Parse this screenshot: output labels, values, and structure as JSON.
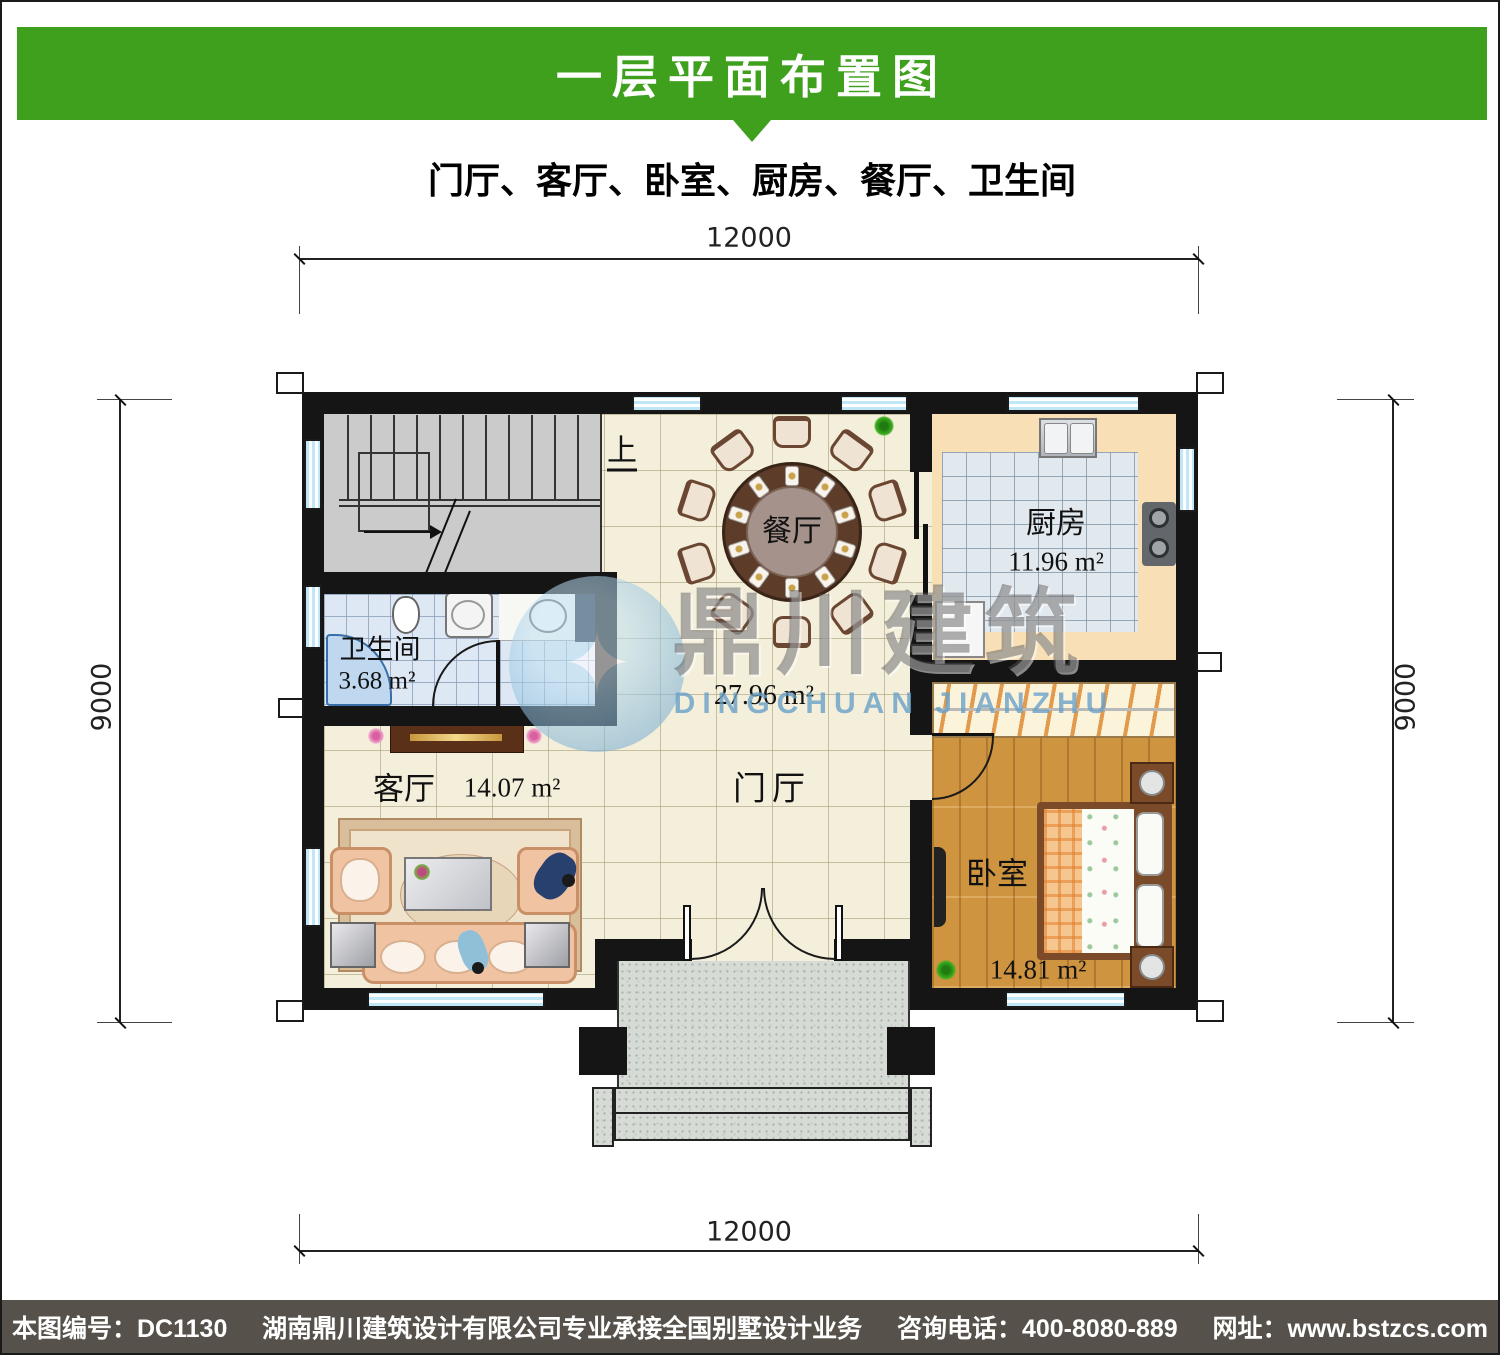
{
  "header": {
    "title": "一层平面布置图"
  },
  "subtitle": "门厅、客厅、卧室、厨房、餐厅、卫生间",
  "dimensions": {
    "top": "12000",
    "bottom": "12000",
    "left": "9000",
    "right": "9000"
  },
  "rooms": {
    "dining": {
      "name": "餐厅"
    },
    "kitchen": {
      "name": "厨房",
      "area": "11.96 m²"
    },
    "bathroom": {
      "name": "卫生间",
      "area": "3.68 m²"
    },
    "living": {
      "name": "客厅",
      "area": "14.07 m²"
    },
    "hall": {
      "name": "门厅",
      "area": "27.96 m²"
    },
    "bedroom": {
      "name": "卧室",
      "area": "14.81 m²"
    },
    "stairs": {
      "direction_label": "上"
    }
  },
  "watermark": {
    "name_cn": "鼎川建筑",
    "name_en": "DINGCHUAN JIANZHU"
  },
  "footer": {
    "drawing_no": "本图编号：DC1130",
    "company": "湖南鼎川建筑设计有限公司专业承接全国别墅设计业务",
    "phone": "咨询电话：400-8080-889",
    "website": "网址：www.bstzcs.com"
  },
  "colors": {
    "banner_green": "#3FA01D",
    "footer_gray": "#56524B",
    "wall": "#151515",
    "window_blue": "#BFE7F5"
  }
}
